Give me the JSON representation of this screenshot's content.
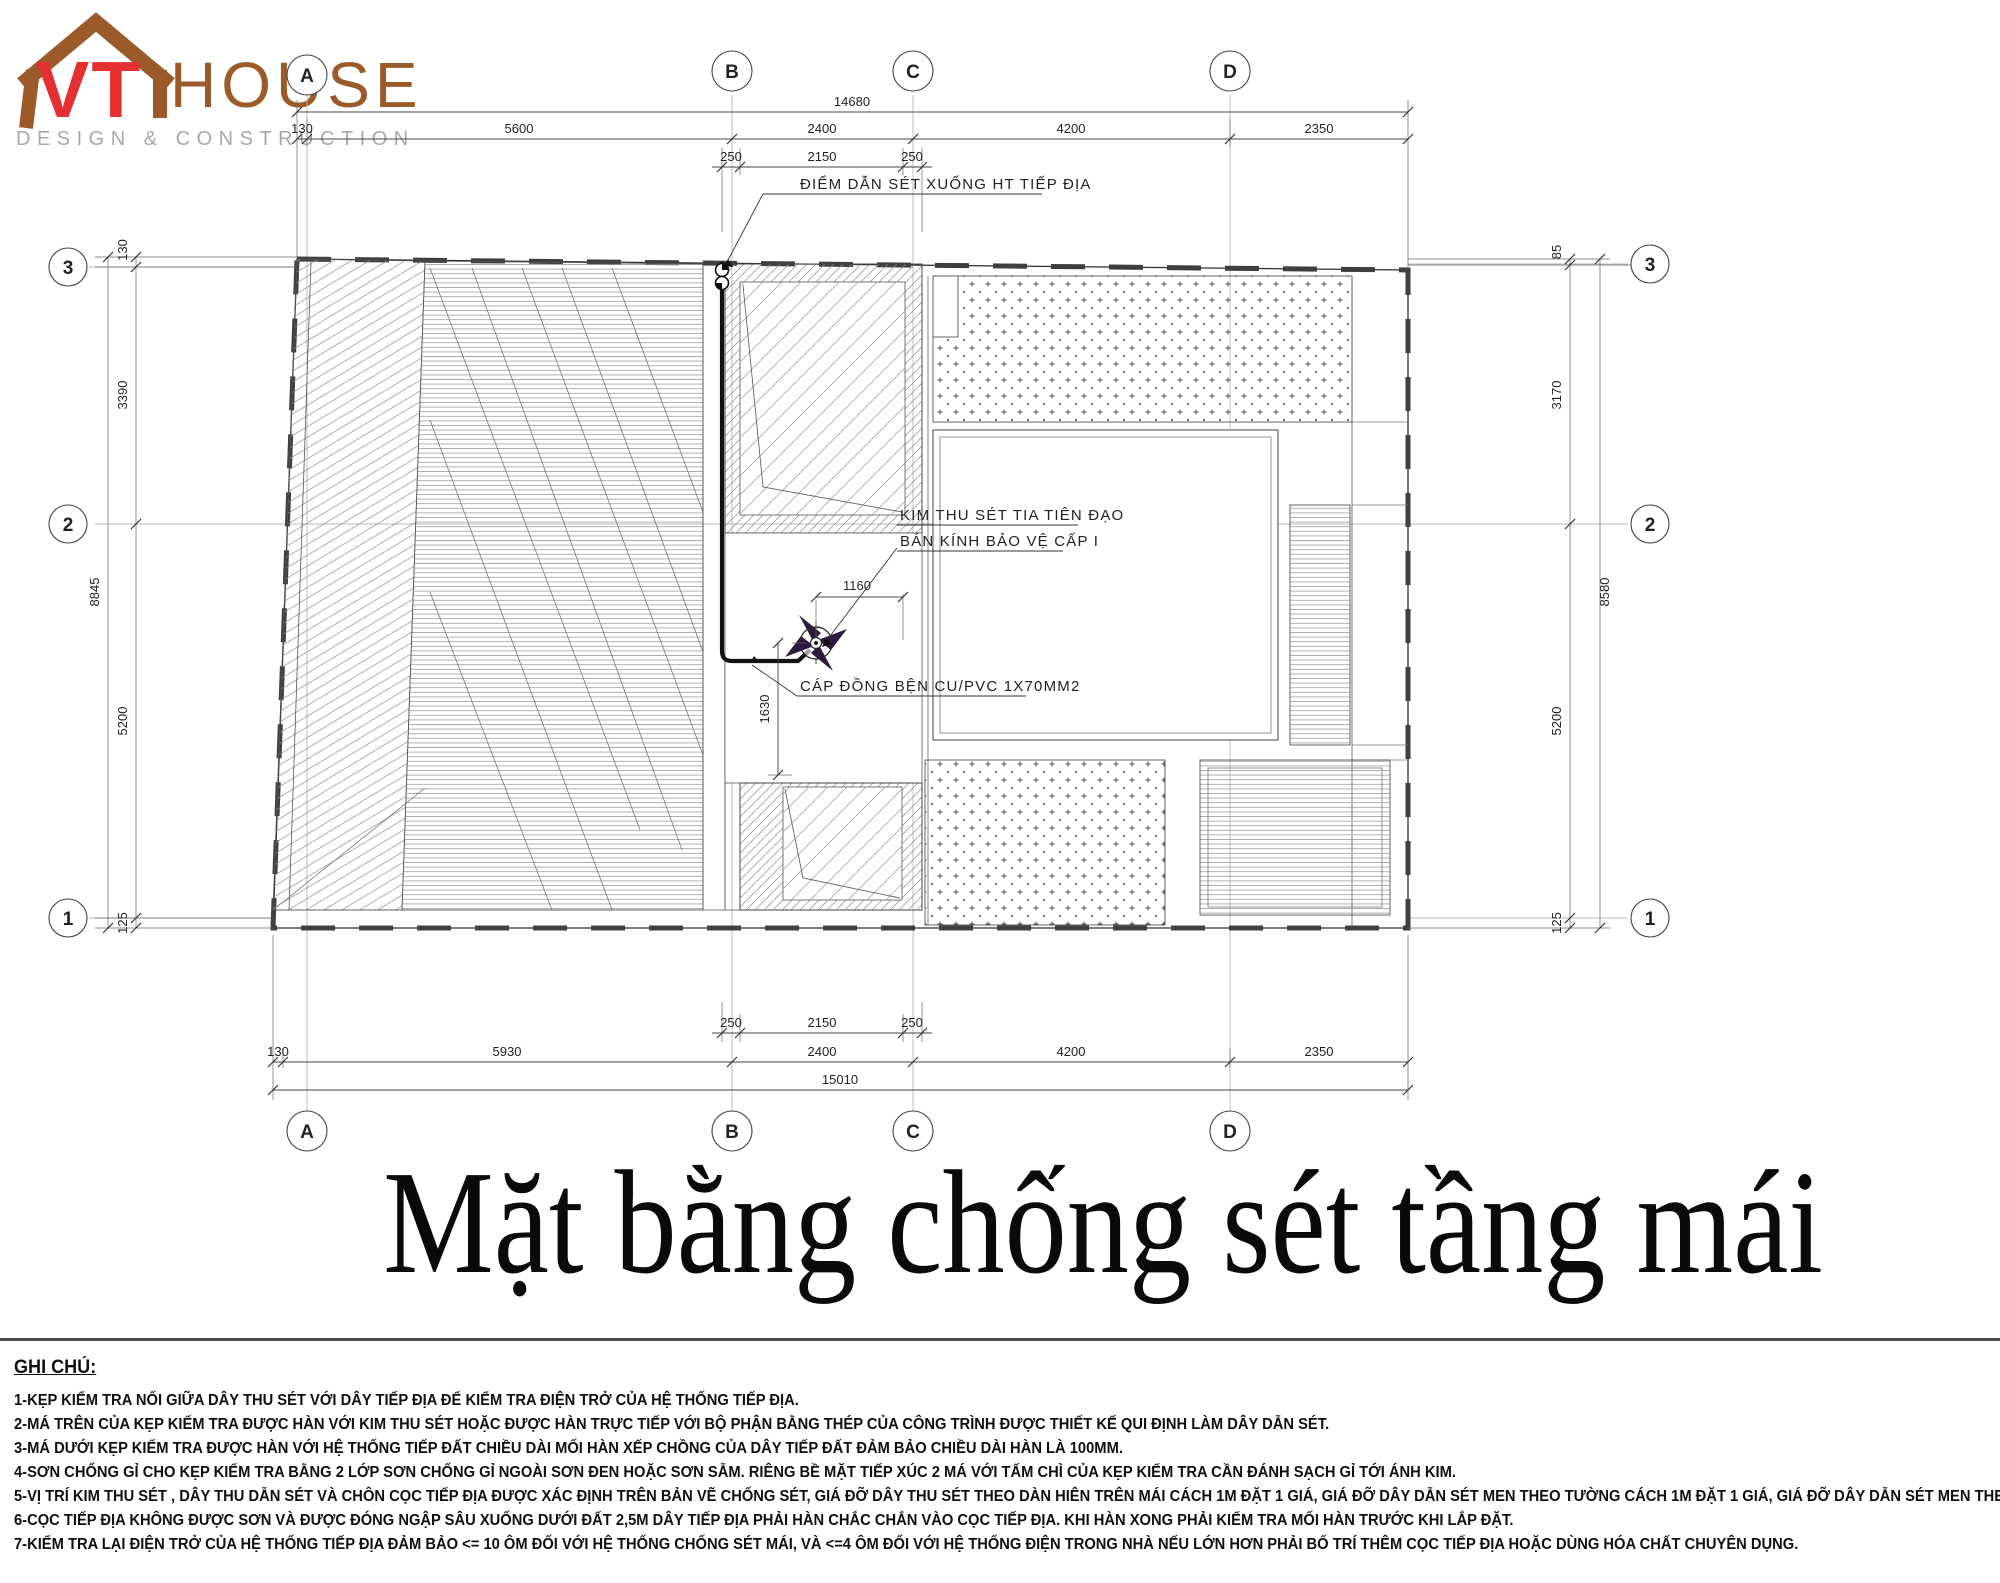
{
  "logo": {
    "vt": "VT",
    "house": "HOUSE",
    "tagline": "DESIGN & CONSTRUCTION"
  },
  "title": "Mặt bằng chống sét tầng mái",
  "grid": {
    "cols": [
      "A",
      "B",
      "C",
      "D"
    ],
    "rows": [
      "3",
      "2",
      "1"
    ]
  },
  "dims": {
    "top": {
      "overall": "14680",
      "spans": [
        "130",
        "5600",
        "2400",
        "4200",
        "2350"
      ],
      "detail": [
        "250",
        "2150",
        "250"
      ]
    },
    "bottom": {
      "overall": "15010",
      "spans": [
        "130",
        "5930",
        "2400",
        "4200",
        "2350"
      ],
      "detail": [
        "250",
        "2150",
        "250"
      ]
    },
    "left": {
      "overall": "8845",
      "spans": [
        "130",
        "3390",
        "5200",
        "125"
      ]
    },
    "right": {
      "overall": "8580",
      "spans": [
        "85",
        "3170",
        "5200",
        "125"
      ]
    },
    "internal": {
      "rod_offset": "1160",
      "cable_run": "1630"
    }
  },
  "labels": {
    "down_conductor_point": "ĐIỂM DẪN SÉT XUỐNG HT TIẾP ĐỊA",
    "rod_line1": "KIM THU SÉT TIA TIÊN ĐẠO",
    "rod_line2": "BÁN KÍNH BẢO VỆ CẤP I",
    "cable": "CÁP ĐỒNG BỆN CU/PVC 1X70MM2"
  },
  "notes": {
    "heading": "GHI CHÚ:",
    "items": [
      "1-KẸP KIỂM TRA NỐI GIỮA DÂY THU SÉT VỚI DÂY TIẾP ĐỊA ĐỂ KIỂM TRA ĐIỆN TRỞ CỦA HỆ THỐNG TIẾP ĐỊA.",
      "2-MÁ TRÊN CỦA KẸP KIỂM TRA ĐƯỢC HÀN VỚI KIM THU SÉT HOẶC ĐƯỢC HÀN TRỰC TIẾP VỚI BỘ PHẬN BẰNG THÉP CỦA CÔNG TRÌNH ĐƯỢC THIẾT KẾ QUI ĐỊNH LÀM DÂY DẪN SÉT.",
      "3-MÁ DƯỚI KẸP KIỂM TRA ĐƯỢC HÀN VỚI HỆ THỐNG TIẾP ĐẤT CHIỀU DÀI MỐI HÀN XẾP CHỒNG CỦA DÂY TIẾP ĐẤT ĐẢM BẢO CHIỀU DÀI HÀN LÀ 100MM.",
      "4-SƠN CHỐNG GỈ CHO KẸP KIỂM TRA BẰNG 2 LỚP SƠN CHỐNG GỈ NGOÀI SƠN ĐEN HOẶC SƠN SẪM. RIÊNG BỀ MẶT TIẾP XÚC 2 MÁ VỚI TẤM CHÌ CỦA KẸP KIỂM TRA CẦN ĐÁNH SẠCH GỈ TỚI ÁNH KIM.",
      "5-VỊ TRÍ KIM THU SÉT , DÂY THU DẪN SÉT VÀ CHÔN CỌC TIẾP ĐỊA ĐƯỢC XÁC ĐỊNH TRÊN BẢN VẼ CHỐNG SÉT, GIÁ ĐỠ DÂY THU SÉT THEO DÀN HIÊN TRÊN MÁI CÁCH 1M ĐẶT 1 GIÁ, GIÁ ĐỠ DÂY DẪN SÉT MEN THEO TƯỜNG CÁCH 1M ĐẶT 1 GIÁ, GIÁ ĐỠ DÂY DẪN SÉT MEN THEO TƯỜNG CÁCH 1,5M ĐẶT 1 GIÁ.",
      "6-CỌC TIẾP ĐỊA KHÔNG ĐƯỢC SƠN VÀ ĐƯỢC ĐÓNG NGẬP SÂU XUỐNG DƯỚI ĐẤT 2,5M DÂY TIẾP ĐỊA PHẢI HÀN CHẮC CHẮN VÀO CỌC TIẾP ĐỊA. KHI HÀN XONG PHẢI KIỂM TRA MỐI HÀN TRƯỚC KHI LẮP ĐẶT.",
      "7-KIỂM TRA LẠI ĐIỆN TRỞ CỦA HỆ THỐNG TIẾP ĐỊA ĐẢM BẢO <= 10 ÔM ĐỐI VỚI HỆ THỐNG CHỐNG SÉT MÁI, VÀ <=4 ÔM ĐỐI VỚI HỆ THỐNG ĐIỆN TRONG NHÀ NẾU LỚN HƠN PHẢI BỐ TRÍ THÊM CỌC TIẾP ĐỊA HOẶC DÙNG HÓA CHẤT CHUYÊN DỤNG."
    ]
  },
  "colors": {
    "brand_brown": "#9c5a28",
    "brand_red": "#e43030",
    "tagline_gray": "#a8a8a8",
    "ink": "#2f2f2f",
    "rod_accent": "#2d1b3d"
  }
}
